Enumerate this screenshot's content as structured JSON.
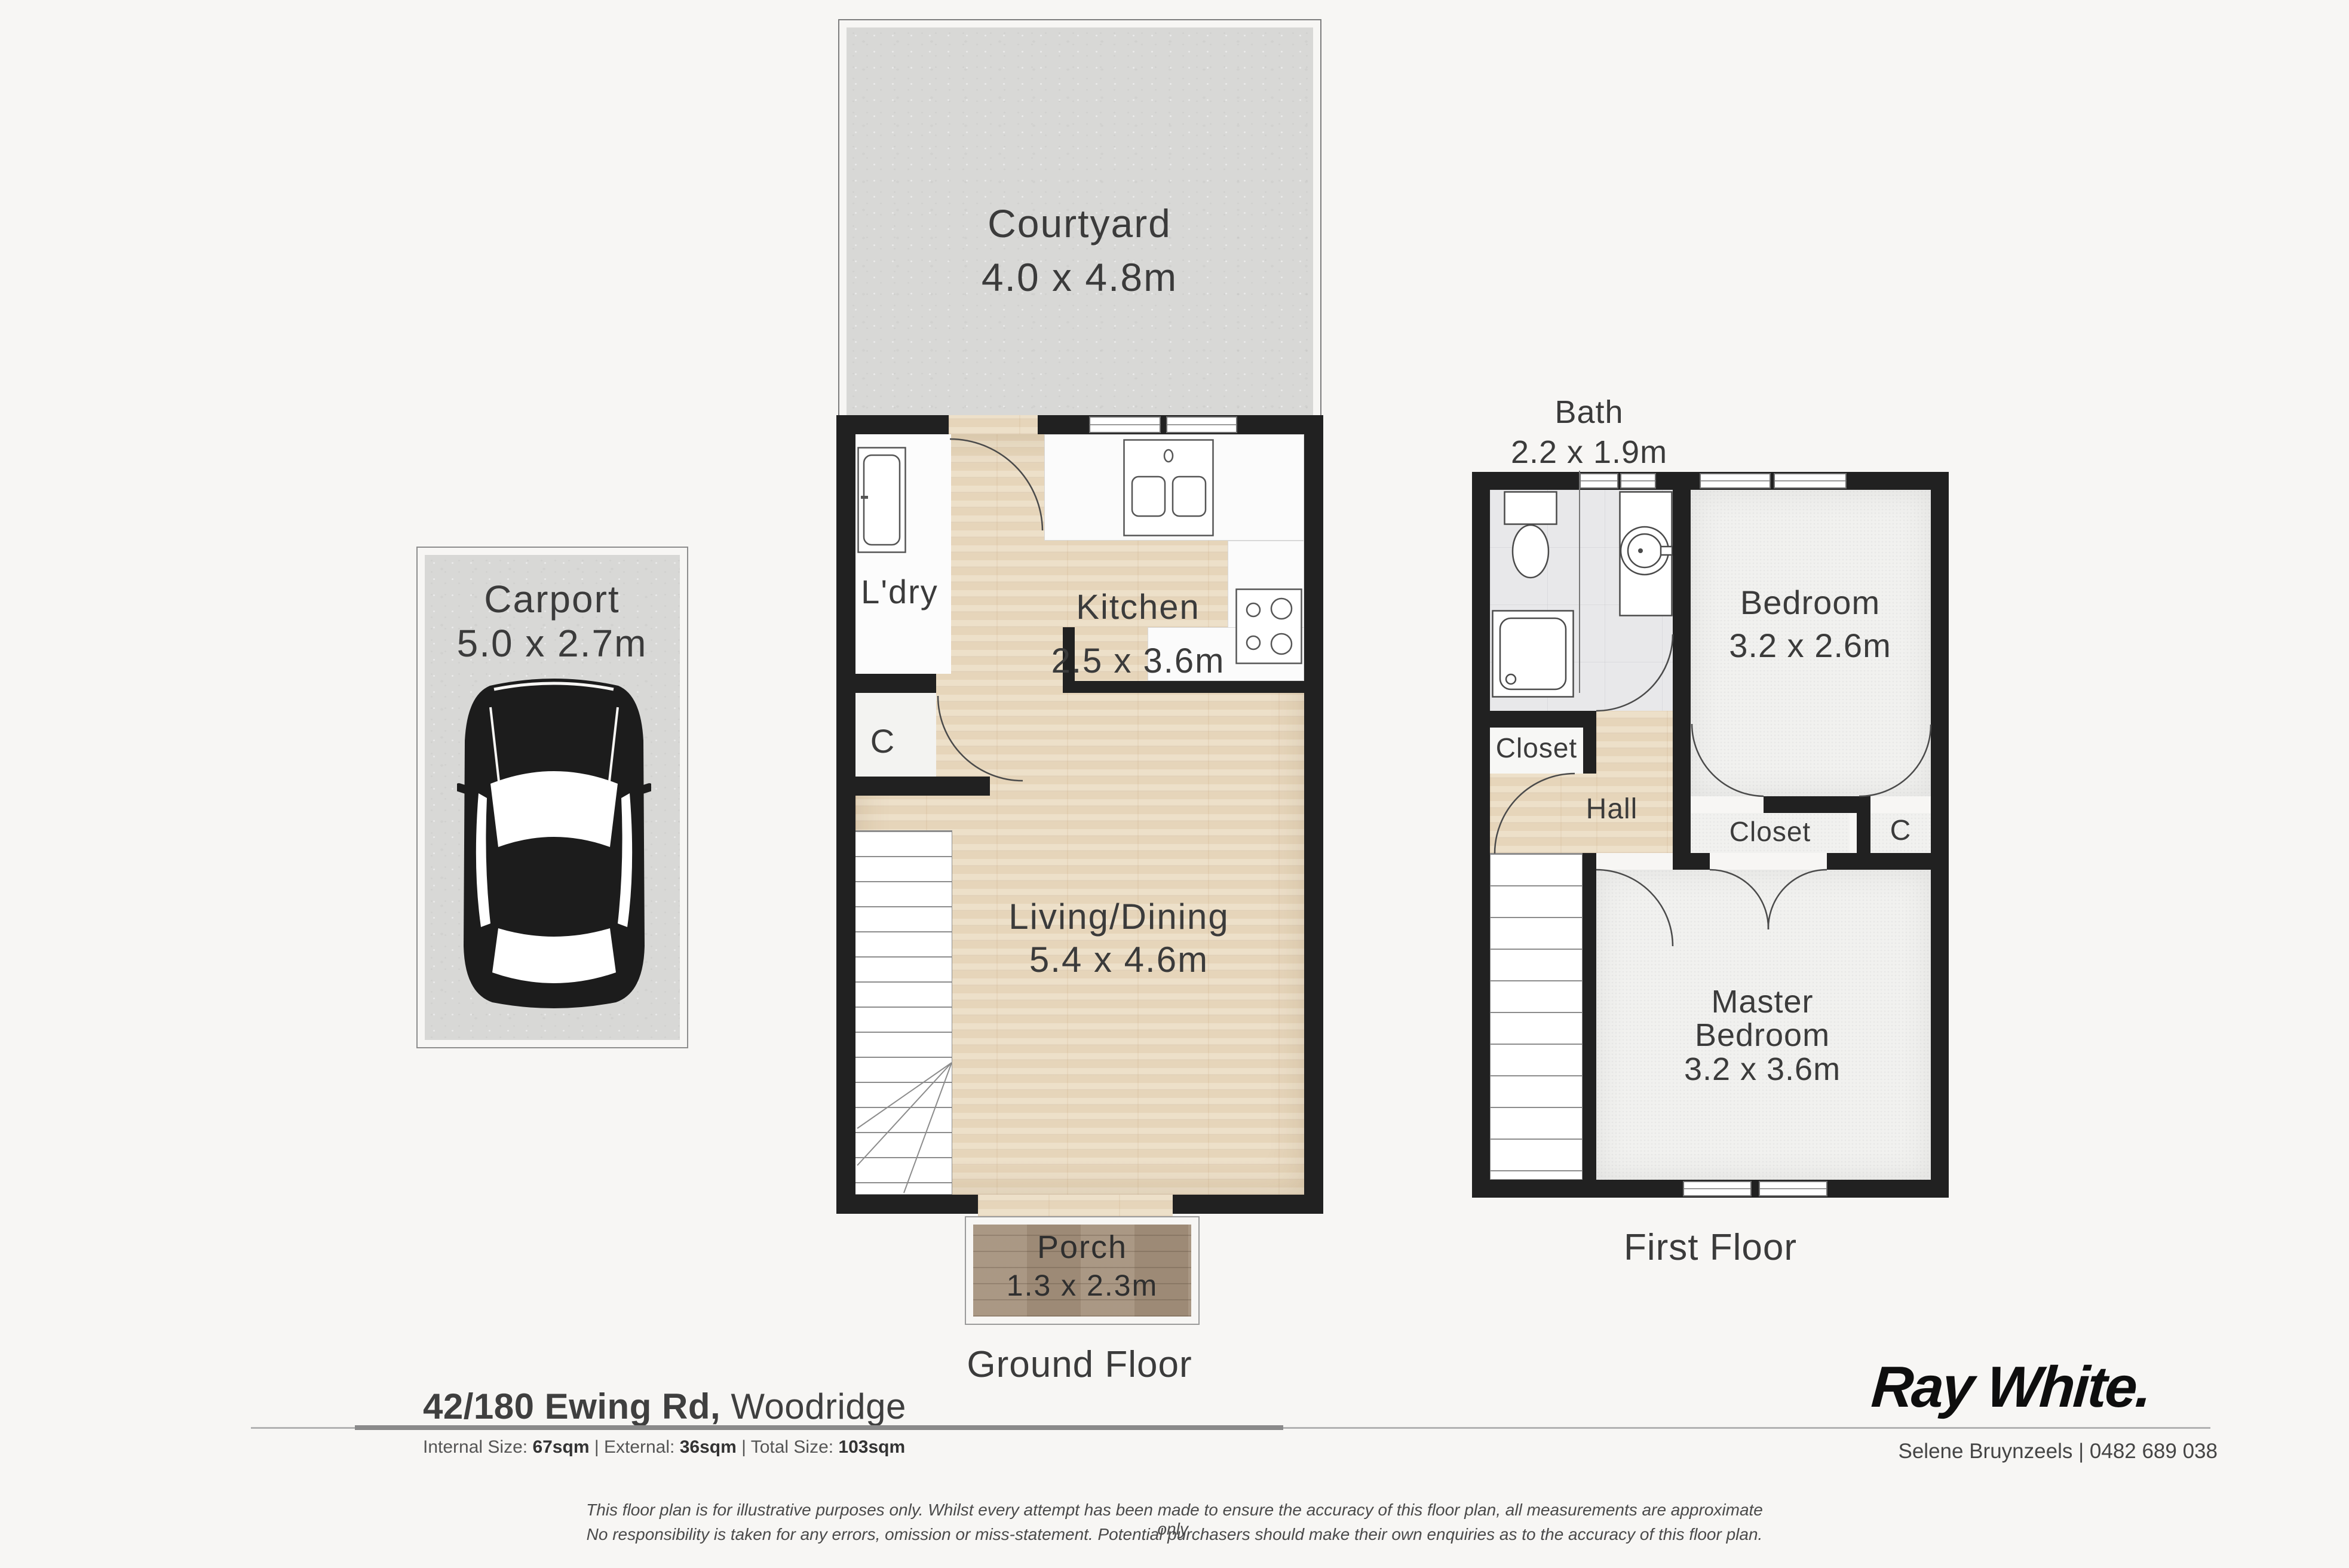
{
  "colors": {
    "background": "#f7f6f4",
    "wall": "#212121",
    "wood_floor": "#ebdcc3",
    "porch_wood": "#a5927e",
    "concrete": "#d8d8d6",
    "tile": "#e8e8ea",
    "carpet": "#f1f1ef",
    "label_text": "#3b3b3b"
  },
  "icons": {
    "car": "car-top-view-icon",
    "washing_machine": "washing-machine-icon",
    "kitchen_sink": "double-sink-icon",
    "stove": "cooktop-icon",
    "toilet": "toilet-icon",
    "vanity": "basin-icon",
    "shower": "shower-icon",
    "stairs": "stairs-icon",
    "door": "door-swing-arc"
  },
  "courtyard": {
    "name": "Courtyard",
    "dims": "4.0 x 4.8m"
  },
  "carport": {
    "name": "Carport",
    "dims": "5.0 x 2.7m"
  },
  "ground_floor": {
    "floor_label": "Ground Floor",
    "laundry": {
      "name": "L'dry"
    },
    "closet": {
      "name": "C"
    },
    "kitchen": {
      "name": "Kitchen",
      "dims": "2.5 x 3.6m"
    },
    "living": {
      "name": "Living/Dining",
      "dims": "5.4 x 4.6m"
    },
    "porch": {
      "name": "Porch",
      "dims": "1.3 x 2.3m"
    }
  },
  "first_floor": {
    "floor_label": "First Floor",
    "bath": {
      "name": "Bath",
      "dims": "2.2 x 1.9m"
    },
    "bedroom": {
      "name": "Bedroom",
      "dims": "3.2 x 2.6m"
    },
    "closet_left": {
      "name": "Closet"
    },
    "hall": {
      "name": "Hall"
    },
    "closet_mid": {
      "name": "Closet"
    },
    "closet_small": {
      "name": "C"
    },
    "master": {
      "line1": "Master",
      "line2": "Bedroom",
      "dims": "3.2 x 3.6m"
    }
  },
  "footer": {
    "address_main": "42/180 Ewing Rd,",
    "address_suburb": " Woodridge",
    "size_internal_label": "Internal Size: ",
    "size_internal": "67sqm",
    "size_external_label": "External: ",
    "size_external": "36sqm",
    "size_total_label": "Total Size: ",
    "size_total": "103sqm",
    "separator": " | "
  },
  "brand": {
    "logo": "Ray White.",
    "agent": "Selene Bruynzeels | 0482 689 038"
  },
  "disclaimer": {
    "line1": "This floor plan is for illustrative purposes only. Whilst every attempt has been made to ensure the accuracy of this floor plan, all measurements are approximate only.",
    "line2": "No responsibility is taken for any errors, omission or miss-statement. Potential purchasers should make their own enquiries as to the accuracy of this floor plan."
  }
}
